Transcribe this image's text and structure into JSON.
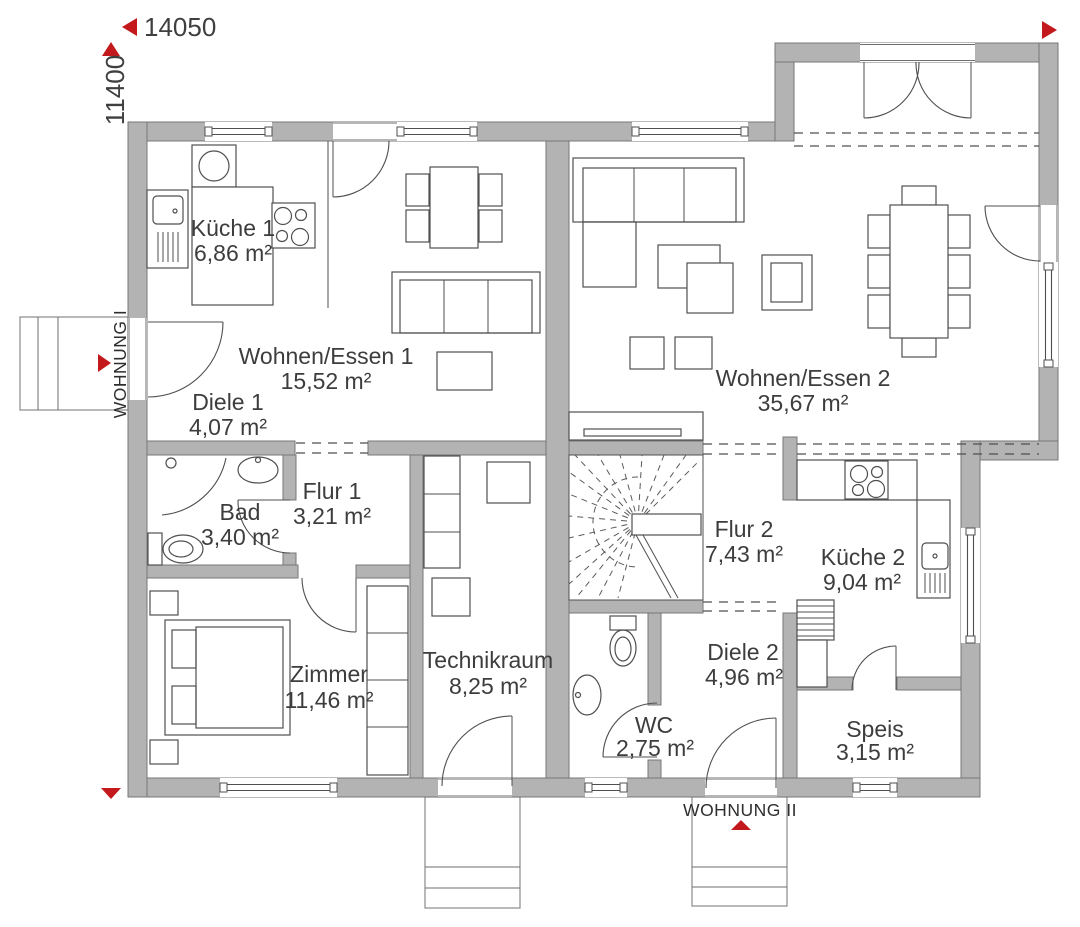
{
  "title": "Erdgeschoss Grundriss Doppelhaus",
  "dimensions": {
    "width_label": "14050",
    "height_label": "11400"
  },
  "entrances": {
    "apartment1": "WOHNUNG I",
    "apartment2": "WOHNUNG II"
  },
  "colors": {
    "wall": "#b3b3b3",
    "wall_outline": "#777777",
    "line": "#4f4f4f",
    "accent_red": "#c3191d",
    "text": "#3d3d3d"
  },
  "rooms": [
    {
      "id": "kueche1",
      "name": "Küche 1",
      "area": "6,86 m²"
    },
    {
      "id": "wohnen_essen1",
      "name": "Wohnen/Essen 1",
      "area": "15,52 m²"
    },
    {
      "id": "diele1",
      "name": "Diele 1",
      "area": "4,07 m²"
    },
    {
      "id": "bad",
      "name": "Bad",
      "area": "3,40 m²"
    },
    {
      "id": "flur1",
      "name": "Flur 1",
      "area": "3,21 m²"
    },
    {
      "id": "zimmer",
      "name": "Zimmer",
      "area": "11,46 m²"
    },
    {
      "id": "technikraum",
      "name": "Technikraum",
      "area": "8,25 m²"
    },
    {
      "id": "wohnen_essen2",
      "name": "Wohnen/Essen 2",
      "area": "35,67 m²"
    },
    {
      "id": "flur2",
      "name": "Flur 2",
      "area": "7,43 m²"
    },
    {
      "id": "kueche2",
      "name": "Küche 2",
      "area": "9,04 m²"
    },
    {
      "id": "diele2",
      "name": "Diele 2",
      "area": "4,96 m²"
    },
    {
      "id": "wc",
      "name": "WC",
      "area": "2,75 m²"
    },
    {
      "id": "speis",
      "name": "Speis",
      "area": "3,15 m²"
    }
  ]
}
